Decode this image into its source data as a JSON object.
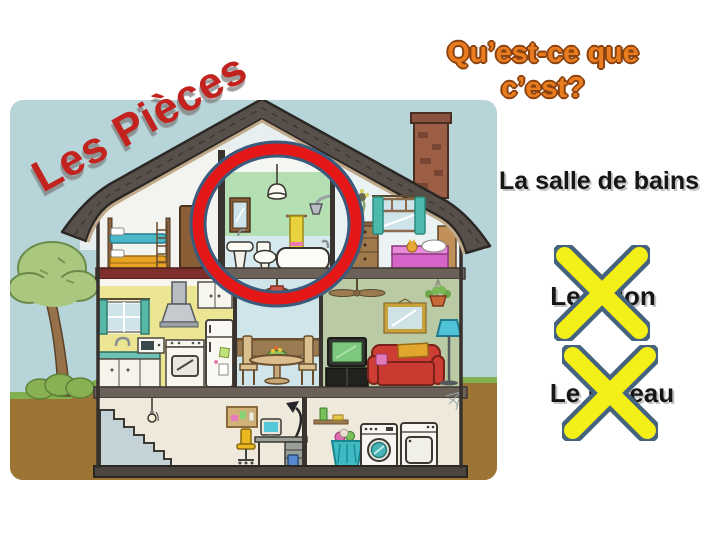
{
  "slide": {
    "title": {
      "text": "Les Pièces",
      "color": "#c2231f"
    },
    "question": {
      "line1": "Qu’est-ce que",
      "line2": "c’est?",
      "color": "#e87c1e"
    },
    "answers": [
      {
        "label": "La salle de bains",
        "crossed_out": false
      },
      {
        "label": "Le salon",
        "crossed_out": true
      },
      {
        "label": "Le bureau",
        "crossed_out": true
      }
    ],
    "illustration": {
      "type": "house cross-section cartoon",
      "highlight": "red circle around the bathroom",
      "highlight_color": "#e61717",
      "cross_color": "#f4ef16",
      "rooms_depicted": [
        "bedroom with bunk bed",
        "bathroom",
        "bedroom",
        "kitchen",
        "dining room",
        "living room",
        "basement with stairs and desk",
        "laundry room"
      ]
    }
  }
}
